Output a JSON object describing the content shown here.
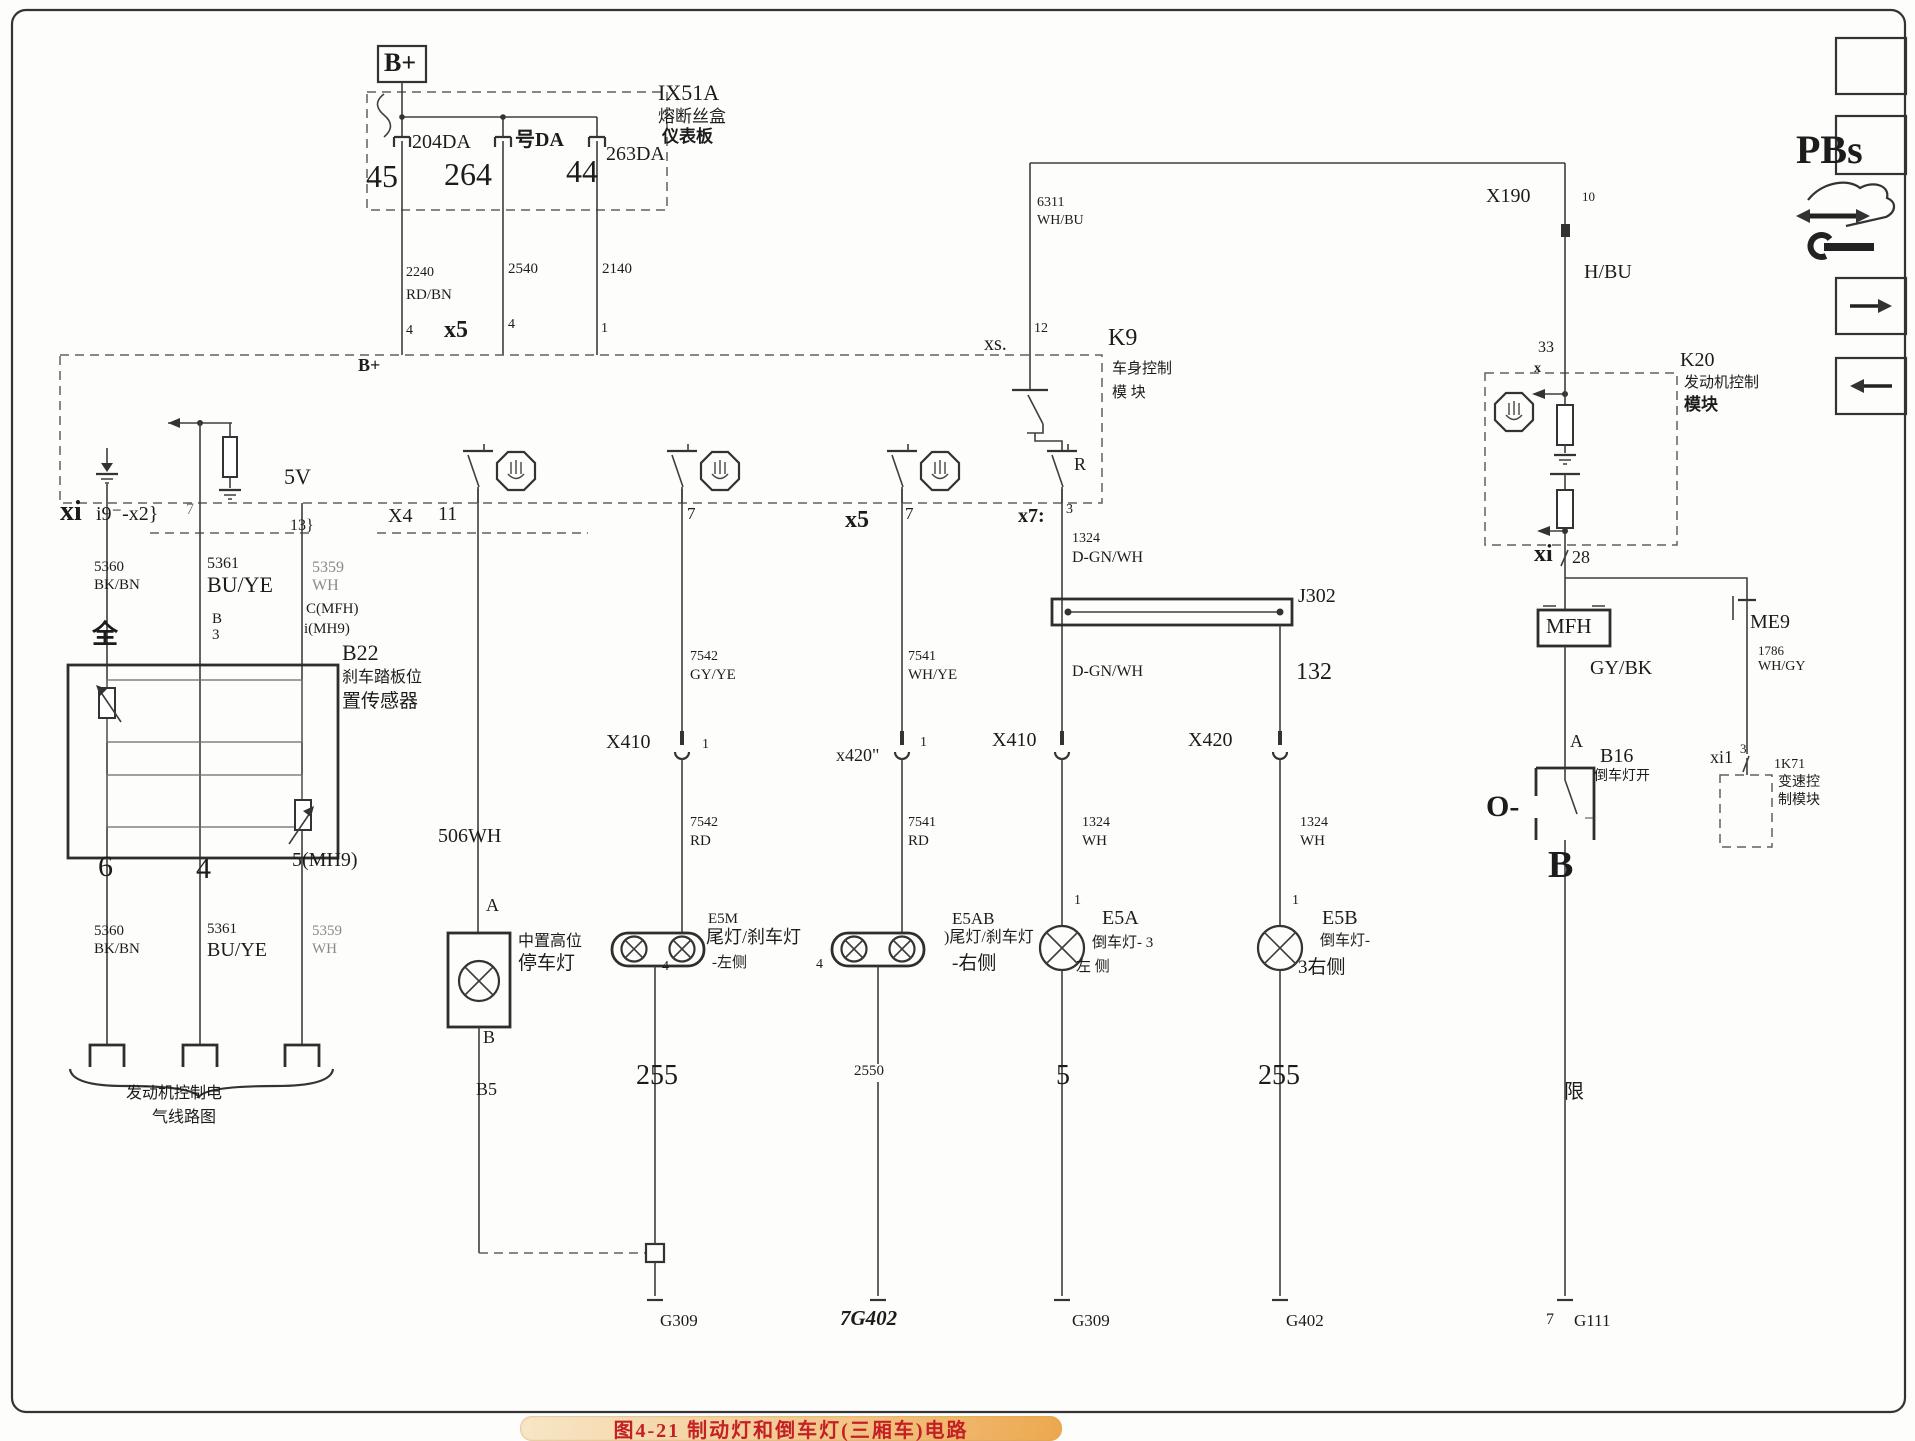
{
  "figure": {
    "caption": "图4-21  制动灯和倒车灯(三厢车)电路"
  },
  "colors": {
    "badge": "#f3c88e",
    "caption_text": "#c42127",
    "wire": "#3e3e3e"
  },
  "labels": [
    {
      "n": "bplus-top-label",
      "t": "B+",
      "x": 384,
      "y": 50,
      "fs": 26,
      "w": 700
    },
    {
      "n": "fuse1-rating",
      "t": "204DA",
      "x": 412,
      "y": 132,
      "fs": 20
    },
    {
      "n": "fuse1-pin",
      "t": "45",
      "x": 366,
      "y": 160,
      "fs": 32
    },
    {
      "n": "fuse2-rating",
      "t": "号DA",
      "x": 515,
      "y": 130,
      "fs": 20,
      "w": 700
    },
    {
      "n": "fuse2-pin",
      "t": "264",
      "x": 444,
      "y": 158,
      "fs": 32
    },
    {
      "n": "fuse3-rating",
      "t": "263DA",
      "x": 606,
      "y": 144,
      "fs": 20
    },
    {
      "n": "fuse3-pin",
      "t": "44",
      "x": 566,
      "y": 155,
      "fs": 32
    },
    {
      "n": "fusebox-id",
      "t": "IX51A",
      "x": 658,
      "y": 82,
      "fs": 22
    },
    {
      "n": "fusebox-name-1",
      "t": "熔断丝盒",
      "x": 658,
      "y": 108,
      "fs": 17
    },
    {
      "n": "fusebox-name-2",
      "t": "仪表板",
      "x": 662,
      "y": 128,
      "fs": 17,
      "w": 700
    },
    {
      "n": "wire-2240",
      "t": "2240",
      "x": 406,
      "y": 266,
      "fs": 14
    },
    {
      "n": "wire-2240-color",
      "t": "RD/BN",
      "x": 406,
      "y": 288,
      "fs": 15
    },
    {
      "n": "pin-4-left",
      "t": "4",
      "x": 406,
      "y": 324,
      "fs": 14
    },
    {
      "n": "wire-2540",
      "t": "2540",
      "x": 508,
      "y": 262,
      "fs": 15
    },
    {
      "n": "conn-x5-top",
      "t": "x5",
      "x": 444,
      "y": 318,
      "fs": 24,
      "w": 700
    },
    {
      "n": "pin-4-mid",
      "t": "4",
      "x": 508,
      "y": 318,
      "fs": 14
    },
    {
      "n": "wire-2140",
      "t": "2140",
      "x": 602,
      "y": 262,
      "fs": 15
    },
    {
      "n": "pin-1-top",
      "t": "1",
      "x": 601,
      "y": 322,
      "fs": 14
    },
    {
      "n": "bplus-bus-label",
      "t": "B+",
      "x": 358,
      "y": 356,
      "fs": 18,
      "w": 700
    },
    {
      "n": "wire-6311",
      "t": "6311",
      "x": 1037,
      "y": 196,
      "fs": 14
    },
    {
      "n": "wire-6311-color",
      "t": "WH/BU",
      "x": 1037,
      "y": 214,
      "fs": 14
    },
    {
      "n": "conn-xs",
      "t": "xs.",
      "x": 984,
      "y": 334,
      "fs": 20
    },
    {
      "n": "pin-12",
      "t": "12",
      "x": 1034,
      "y": 322,
      "fs": 14
    },
    {
      "n": "k9-id",
      "t": "K9",
      "x": 1108,
      "y": 326,
      "fs": 24
    },
    {
      "n": "k9-name-1",
      "t": "车身控制",
      "x": 1112,
      "y": 362,
      "fs": 15
    },
    {
      "n": "k9-name-2",
      "t": "模 块",
      "x": 1112,
      "y": 386,
      "fs": 15
    },
    {
      "n": "relay-r-label",
      "t": "R",
      "x": 1074,
      "y": 455,
      "fs": 18
    },
    {
      "n": "conn-x4",
      "t": "X4",
      "x": 388,
      "y": 506,
      "fs": 20
    },
    {
      "n": "pin-11",
      "t": "11",
      "x": 438,
      "y": 504,
      "fs": 20
    },
    {
      "n": "pin-7-s2",
      "t": "7",
      "x": 687,
      "y": 505,
      "fs": 17
    },
    {
      "n": "conn-x5-s3",
      "t": "x5",
      "x": 845,
      "y": 508,
      "fs": 24,
      "w": 700
    },
    {
      "n": "pin-7-s3",
      "t": "7",
      "x": 905,
      "y": 505,
      "fs": 17
    },
    {
      "n": "conn-x7",
      "t": "x7:",
      "x": 1018,
      "y": 506,
      "fs": 20,
      "w": 700
    },
    {
      "n": "pin-3-s4",
      "t": "3",
      "x": 1066,
      "y": 503,
      "fs": 14
    },
    {
      "n": "conn-xi-left",
      "t": "xi",
      "x": 60,
      "y": 498,
      "fs": 28,
      "w": 700
    },
    {
      "n": "conn-i9x2",
      "t": "i9⁻-x2}",
      "x": 96,
      "y": 504,
      "fs": 20
    },
    {
      "n": "pin-7-left",
      "t": "7",
      "x": 186,
      "y": 502,
      "fs": 16,
      "c": "#777777"
    },
    {
      "n": "label-5v",
      "t": "5V",
      "x": 284,
      "y": 466,
      "fs": 22
    },
    {
      "n": "pin-13",
      "t": "13}",
      "x": 290,
      "y": 518,
      "fs": 16
    },
    {
      "n": "wire-5360-upper",
      "t": "5360",
      "x": 94,
      "y": 560,
      "fs": 15
    },
    {
      "n": "wire-5360-upper-color",
      "t": "BK/BN",
      "x": 94,
      "y": 578,
      "fs": 15
    },
    {
      "n": "wire-5361-upper",
      "t": "5361",
      "x": 207,
      "y": 556,
      "fs": 16
    },
    {
      "n": "wire-5361-upper-color",
      "t": "BU/YE",
      "x": 207,
      "y": 574,
      "fs": 22
    },
    {
      "n": "wire-5359-upper",
      "t": "5359",
      "x": 312,
      "y": 560,
      "fs": 16,
      "c": "#8a8a8a"
    },
    {
      "n": "wire-5359-upper-color",
      "t": "WH",
      "x": 312,
      "y": 578,
      "fs": 16,
      "c": "#8a8a8a"
    },
    {
      "n": "pin-quan",
      "t": "全",
      "x": 92,
      "y": 622,
      "fs": 26,
      "w": 700
    },
    {
      "n": "pin-b-b22",
      "t": "B",
      "x": 212,
      "y": 612,
      "fs": 15
    },
    {
      "n": "pin-3-b22",
      "t": "3",
      "x": 212,
      "y": 628,
      "fs": 15
    },
    {
      "n": "pin-c-mfh",
      "t": "C(MFH)",
      "x": 306,
      "y": 602,
      "fs": 15
    },
    {
      "n": "pin-i-mh9",
      "t": "i(MH9)",
      "x": 304,
      "y": 622,
      "fs": 15
    },
    {
      "n": "b22-id",
      "t": "B22",
      "x": 342,
      "y": 642,
      "fs": 22
    },
    {
      "n": "b22-name-1",
      "t": "刹车踏板位",
      "x": 342,
      "y": 670,
      "fs": 16
    },
    {
      "n": "b22-name-2",
      "t": "置传感器",
      "x": 342,
      "y": 692,
      "fs": 19
    },
    {
      "n": "pin-6-b22",
      "t": "6",
      "x": 98,
      "y": 852,
      "fs": 30
    },
    {
      "n": "pin-4-b22",
      "t": "4",
      "x": 196,
      "y": 854,
      "fs": 30
    },
    {
      "n": "pin-5mh9-b22",
      "t": "5(MH9)",
      "x": 292,
      "y": 850,
      "fs": 20
    },
    {
      "n": "wire-5360-lower",
      "t": "5360",
      "x": 94,
      "y": 924,
      "fs": 15
    },
    {
      "n": "wire-5360-lower-color",
      "t": "BK/BN",
      "x": 94,
      "y": 942,
      "fs": 15
    },
    {
      "n": "wire-5361-lower",
      "t": "5361",
      "x": 207,
      "y": 922,
      "fs": 15
    },
    {
      "n": "wire-5361-lower-color",
      "t": "BU/YE",
      "x": 207,
      "y": 940,
      "fs": 20
    },
    {
      "n": "wire-5359-lower",
      "t": "5359",
      "x": 312,
      "y": 924,
      "fs": 15,
      "c": "#8a8a8a"
    },
    {
      "n": "wire-5359-lower-color",
      "t": "WH",
      "x": 312,
      "y": 942,
      "fs": 15,
      "c": "#8a8a8a"
    },
    {
      "n": "ecm-note-1",
      "t": "发动机控制电",
      "x": 126,
      "y": 1086,
      "fs": 16
    },
    {
      "n": "ecm-note-2",
      "t": "气线路图",
      "x": 152,
      "y": 1110,
      "fs": 16
    },
    {
      "n": "wire-506wh",
      "t": "506WH",
      "x": 438,
      "y": 826,
      "fs": 20
    },
    {
      "n": "pin-a-chmsl",
      "t": "A",
      "x": 486,
      "y": 896,
      "fs": 18
    },
    {
      "n": "chmsl-name-1",
      "t": "中置高位",
      "x": 518,
      "y": 934,
      "fs": 16
    },
    {
      "n": "chmsl-name-2",
      "t": "停车灯",
      "x": 518,
      "y": 954,
      "fs": 19
    },
    {
      "n": "pin-b-chmsl",
      "t": "B",
      "x": 483,
      "y": 1028,
      "fs": 18
    },
    {
      "n": "wire-b5",
      "t": "B5",
      "x": 476,
      "y": 1080,
      "fs": 18
    },
    {
      "n": "wire-7542-upper",
      "t": "7542",
      "x": 690,
      "y": 650,
      "fs": 14
    },
    {
      "n": "wire-7542-upper-color",
      "t": "GY/YE",
      "x": 690,
      "y": 668,
      "fs": 15
    },
    {
      "n": "conn-x410-e5m",
      "t": "X410",
      "x": 606,
      "y": 732,
      "fs": 20
    },
    {
      "n": "pin-1-e5m",
      "t": "1",
      "x": 702,
      "y": 738,
      "fs": 14
    },
    {
      "n": "wire-7542-lower",
      "t": "7542",
      "x": 690,
      "y": 816,
      "fs": 14
    },
    {
      "n": "wire-7542-lower-color",
      "t": "RD",
      "x": 690,
      "y": 834,
      "fs": 15
    },
    {
      "n": "e5m-id",
      "t": "E5M",
      "x": 708,
      "y": 912,
      "fs": 15
    },
    {
      "n": "e5m-name-1",
      "t": "尾灯/刹车灯",
      "x": 706,
      "y": 928,
      "fs": 18
    },
    {
      "n": "e5m-name-2",
      "t": "-左侧",
      "x": 712,
      "y": 956,
      "fs": 15
    },
    {
      "n": "pin-4-e5m",
      "t": "4",
      "x": 662,
      "y": 960,
      "fs": 14
    },
    {
      "n": "wire-255-e5m",
      "t": "255",
      "x": 636,
      "y": 1062,
      "fs": 28
    },
    {
      "n": "gnd-g309-a",
      "t": "G309",
      "x": 660,
      "y": 1312,
      "fs": 17
    },
    {
      "n": "wire-7541-upper",
      "t": "7541",
      "x": 908,
      "y": 650,
      "fs": 14
    },
    {
      "n": "wire-7541-upper-color",
      "t": "WH/YE",
      "x": 908,
      "y": 668,
      "fs": 15
    },
    {
      "n": "conn-x420-quote",
      "t": "x420\"",
      "x": 836,
      "y": 746,
      "fs": 18
    },
    {
      "n": "pin-1-e5ab",
      "t": "1",
      "x": 920,
      "y": 736,
      "fs": 14
    },
    {
      "n": "wire-7541-lower",
      "t": "7541",
      "x": 908,
      "y": 816,
      "fs": 14
    },
    {
      "n": "wire-7541-lower-color",
      "t": "RD",
      "x": 908,
      "y": 834,
      "fs": 15
    },
    {
      "n": "e5ab-id",
      "t": "E5AB",
      "x": 952,
      "y": 910,
      "fs": 17
    },
    {
      "n": "e5ab-name-1",
      "t": ")尾灯/刹车灯",
      "x": 944,
      "y": 930,
      "fs": 16
    },
    {
      "n": "e5ab-name-2",
      "t": "-右侧",
      "x": 952,
      "y": 954,
      "fs": 19
    },
    {
      "n": "pin-4-e5ab",
      "t": "4",
      "x": 816,
      "y": 958,
      "fs": 14
    },
    {
      "n": "wire-2550",
      "t": "2550",
      "x": 854,
      "y": 1064,
      "fs": 15
    },
    {
      "n": "gnd-7g402",
      "t": "7G402",
      "x": 840,
      "y": 1308,
      "fs": 21,
      "w": 700,
      "i": 1
    },
    {
      "n": "wire-1324-upper",
      "t": "1324",
      "x": 1072,
      "y": 532,
      "fs": 14
    },
    {
      "n": "wire-1324-upper-color",
      "t": "D-GN/WH",
      "x": 1072,
      "y": 550,
      "fs": 16
    },
    {
      "n": "j302-id",
      "t": "J302",
      "x": 1298,
      "y": 586,
      "fs": 20
    },
    {
      "n": "wire-dgnwh-lower",
      "t": "D-GN/WH",
      "x": 1072,
      "y": 664,
      "fs": 16
    },
    {
      "n": "conn-x410-e5a",
      "t": "X410",
      "x": 992,
      "y": 730,
      "fs": 20
    },
    {
      "n": "wire-1324-e5a",
      "t": "1324",
      "x": 1082,
      "y": 816,
      "fs": 14
    },
    {
      "n": "wire-1324-e5a-color",
      "t": "WH",
      "x": 1082,
      "y": 834,
      "fs": 15
    },
    {
      "n": "pin-1-e5a",
      "t": "1",
      "x": 1074,
      "y": 894,
      "fs": 14
    },
    {
      "n": "e5a-id",
      "t": "E5A",
      "x": 1102,
      "y": 908,
      "fs": 20
    },
    {
      "n": "e5a-name-1",
      "t": "倒车灯- 3",
      "x": 1092,
      "y": 936,
      "fs": 15
    },
    {
      "n": "e5a-name-2",
      "t": "左 侧",
      "x": 1076,
      "y": 960,
      "fs": 15
    },
    {
      "n": "wire-5-e5a",
      "t": "5",
      "x": 1056,
      "y": 1062,
      "fs": 28
    },
    {
      "n": "gnd-g309-b",
      "t": "G309",
      "x": 1072,
      "y": 1312,
      "fs": 17
    },
    {
      "n": "wire-132",
      "t": "132",
      "x": 1296,
      "y": 660,
      "fs": 24
    },
    {
      "n": "conn-x420-e5b",
      "t": "X420",
      "x": 1188,
      "y": 730,
      "fs": 20
    },
    {
      "n": "wire-1324-e5b",
      "t": "1324",
      "x": 1300,
      "y": 816,
      "fs": 14
    },
    {
      "n": "wire-1324-e5b-color",
      "t": "WH",
      "x": 1300,
      "y": 834,
      "fs": 15
    },
    {
      "n": "pin-1-e5b",
      "t": "1",
      "x": 1292,
      "y": 894,
      "fs": 14
    },
    {
      "n": "e5b-id",
      "t": "E5B",
      "x": 1322,
      "y": 908,
      "fs": 20
    },
    {
      "n": "e5b-name-1",
      "t": "倒车灯-",
      "x": 1320,
      "y": 934,
      "fs": 15
    },
    {
      "n": "e5b-name-2",
      "t": "3右侧",
      "x": 1298,
      "y": 958,
      "fs": 19
    },
    {
      "n": "wire-255-e5b",
      "t": "255",
      "x": 1258,
      "y": 1062,
      "fs": 28
    },
    {
      "n": "gnd-g402",
      "t": "G402",
      "x": 1286,
      "y": 1312,
      "fs": 17
    },
    {
      "n": "conn-x190",
      "t": "X190",
      "x": 1486,
      "y": 186,
      "fs": 20
    },
    {
      "n": "pin-10",
      "t": "10",
      "x": 1582,
      "y": 190,
      "fs": 13
    },
    {
      "n": "wire-hbu",
      "t": "H/BU",
      "x": 1584,
      "y": 262,
      "fs": 20
    },
    {
      "n": "pin-33",
      "t": "33",
      "x": 1538,
      "y": 340,
      "fs": 16
    },
    {
      "n": "pin-x-k20",
      "t": "x",
      "x": 1534,
      "y": 362,
      "fs": 14,
      "w": 700
    },
    {
      "n": "k20-id",
      "t": "K20",
      "x": 1680,
      "y": 350,
      "fs": 20
    },
    {
      "n": "k20-name-1",
      "t": "发动机控制",
      "x": 1684,
      "y": 376,
      "fs": 15
    },
    {
      "n": "k20-name-2",
      "t": "模块",
      "x": 1684,
      "y": 396,
      "fs": 17,
      "w": 700
    },
    {
      "n": "conn-xi-right",
      "t": "xi",
      "x": 1534,
      "y": 542,
      "fs": 24,
      "w": 700
    },
    {
      "n": "pin-28",
      "t": "28",
      "x": 1572,
      "y": 548,
      "fs": 18
    },
    {
      "n": "mfh-label",
      "t": "MFH",
      "x": 1546,
      "y": 616,
      "fs": 21
    },
    {
      "n": "me9-id",
      "t": "ME9",
      "x": 1750,
      "y": 612,
      "fs": 20
    },
    {
      "n": "wire-gybk",
      "t": "GY/BK",
      "x": 1590,
      "y": 658,
      "fs": 20
    },
    {
      "n": "wire-1786",
      "t": "1786",
      "x": 1758,
      "y": 644,
      "fs": 13
    },
    {
      "n": "wire-1786-color",
      "t": "WH/GY",
      "x": 1758,
      "y": 660,
      "fs": 14
    },
    {
      "n": "pin-a-b16",
      "t": "A",
      "x": 1570,
      "y": 732,
      "fs": 18
    },
    {
      "n": "b16-id",
      "t": "B16",
      "x": 1600,
      "y": 746,
      "fs": 20
    },
    {
      "n": "b16-name",
      "t": "倒车灯开",
      "x": 1594,
      "y": 770,
      "fs": 14
    },
    {
      "n": "b16-o-label",
      "t": "O-",
      "x": 1486,
      "y": 792,
      "fs": 30,
      "w": 700
    },
    {
      "n": "pin-b-b16",
      "t": "B",
      "x": 1548,
      "y": 846,
      "fs": 38,
      "w": 700
    },
    {
      "n": "wire-xian",
      "t": "限",
      "x": 1564,
      "y": 1082,
      "fs": 20
    },
    {
      "n": "pin-7-g111",
      "t": "7",
      "x": 1546,
      "y": 1312,
      "fs": 16
    },
    {
      "n": "gnd-g111",
      "t": "G111",
      "x": 1574,
      "y": 1312,
      "fs": 17
    },
    {
      "n": "conn-xi1",
      "t": "xi1",
      "x": 1710,
      "y": 748,
      "fs": 18
    },
    {
      "n": "pin-3-xi1",
      "t": "3",
      "x": 1740,
      "y": 742,
      "fs": 13
    },
    {
      "n": "k71-id",
      "t": "1K71",
      "x": 1774,
      "y": 758,
      "fs": 14
    },
    {
      "n": "k71-name-1",
      "t": "变速控",
      "x": 1778,
      "y": 776,
      "fs": 14
    },
    {
      "n": "k71-name-2",
      "t": "制模块",
      "x": 1778,
      "y": 794,
      "fs": 14
    },
    {
      "n": "legend-pbs",
      "t": "PBs",
      "x": 1796,
      "y": 130,
      "fs": 40,
      "w": 700
    }
  ]
}
